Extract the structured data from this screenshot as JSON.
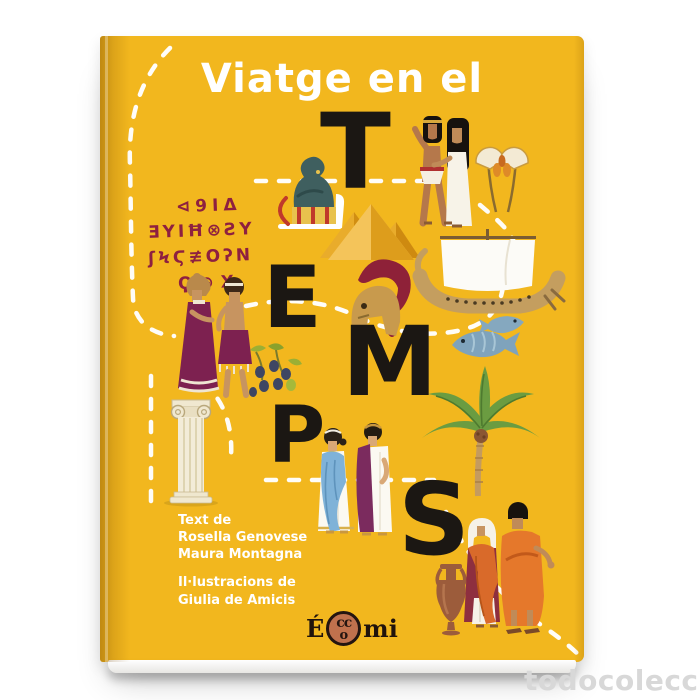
{
  "page": {
    "background_color": "#ffffff"
  },
  "watermark": {
    "text": "todocoleccion",
    "color": "#d8d8d8"
  },
  "book": {
    "cover_color": "#F2B71E",
    "title": "Viatge en el",
    "big_letters": [
      "T",
      "E",
      "M",
      "P",
      "S"
    ],
    "inscription": {
      "color": "#8E2040",
      "lines": [
        "⊲9IΔ",
        "ƎYIĦ⊗ƧY",
        "ʃϞϚ≢ΟʔN",
        "Ϙ⊕X"
      ]
    },
    "credits": {
      "text_label": "Text de",
      "authors": [
        "Rosella Genovese",
        "Maura Montagna"
      ],
      "illustrations_label": "Il·lustracions de",
      "illustrator": "Giulia de Amicis"
    },
    "publisher": {
      "e": "É",
      "cc": "cc",
      "o": "o",
      "mi": "mi",
      "circle_color": "#C0714D"
    },
    "illustrations": [
      "dashed-journey-path",
      "statue-on-sled",
      "egyptian-couple",
      "papyrus-flowers",
      "pyramids",
      "greek-ship",
      "corinthian-helmet",
      "fish-pair",
      "minoan-couple",
      "olive-branch",
      "palm-tree",
      "ionic-column",
      "greek-couple",
      "amphora",
      "roman-couple"
    ]
  }
}
